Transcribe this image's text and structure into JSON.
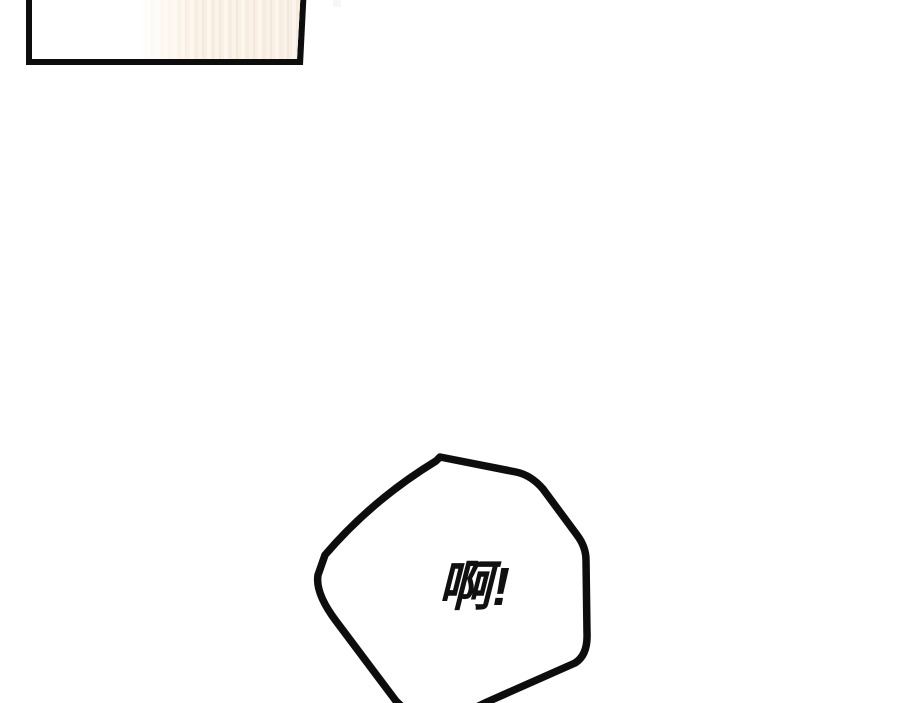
{
  "page": {
    "background_color": "#ffffff",
    "ink_color": "#0d0d0d"
  },
  "panel": {
    "border_color": "#0d0d0d",
    "fill_color": "#ffffff",
    "curtain_stripe_colors": [
      "#f0e4d6",
      "#f8efe5",
      "#fdf9f4",
      "#f4e9dc"
    ],
    "curtain_wash_color": "#fdf1dd"
  },
  "speech_bubble": {
    "text": "啊!",
    "outline_color": "#0d0d0d",
    "fill_color": "#ffffff",
    "text_color": "#101010"
  }
}
